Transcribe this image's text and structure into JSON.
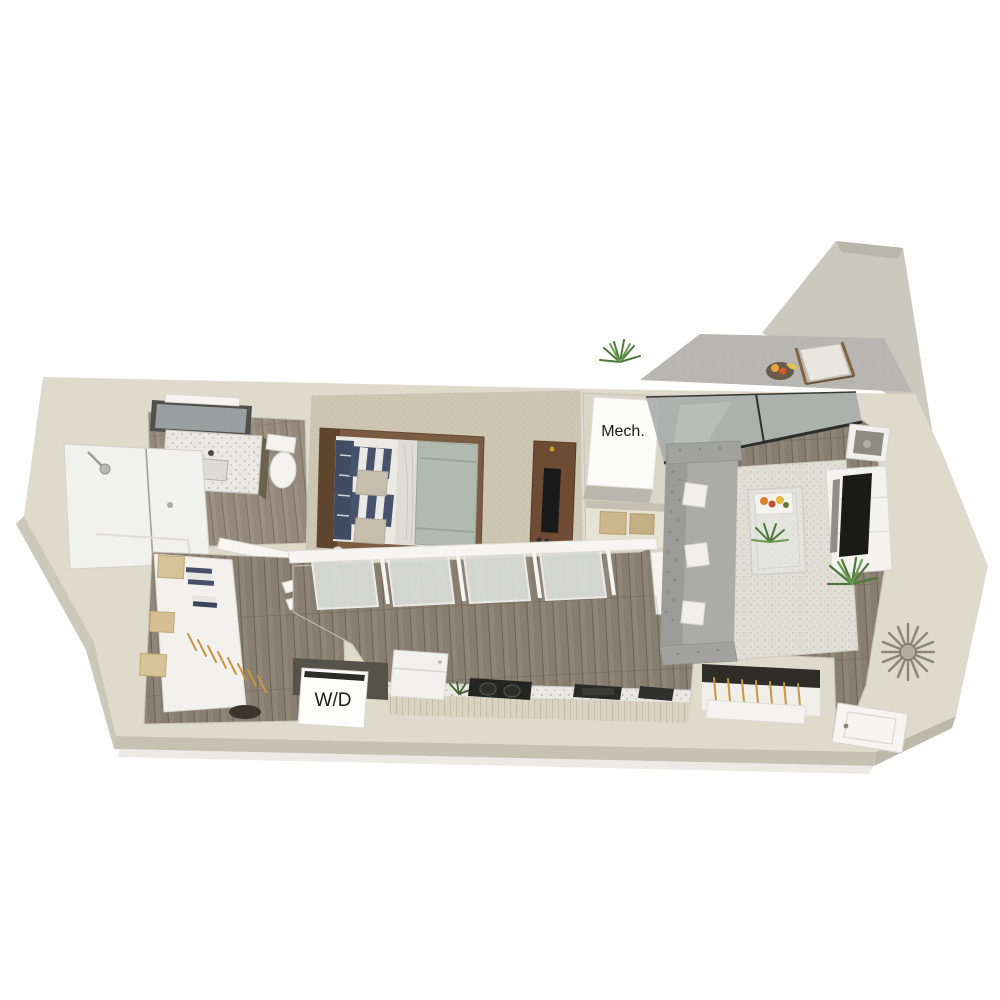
{
  "image": {
    "kind": "3d-floor-plan-rendering",
    "background": "#ffffff"
  },
  "labels": {
    "mech_closet": "Mech.",
    "washer_dryer": "W/D"
  },
  "colors": {
    "wall": "#dfdbcc",
    "wall_shadow": "#c8c4b5",
    "wood_floor": "#877d70",
    "bathroom_floor": "#8f8577",
    "carpet": "#cdc6b2",
    "balcony_concrete": "#b7b6b2",
    "rug": "#e0ddd4",
    "sofa_gray": "#a9a9a7",
    "duvet_sage": "#b1bab0",
    "pillow_navy": "#46516a",
    "furniture_wood": "#6f4e35",
    "appliance_black": "#1e1e1c",
    "plant_green": "#4c7839",
    "storage_tan": "#d5bf93",
    "fixture_white": "#f5f4f0"
  }
}
